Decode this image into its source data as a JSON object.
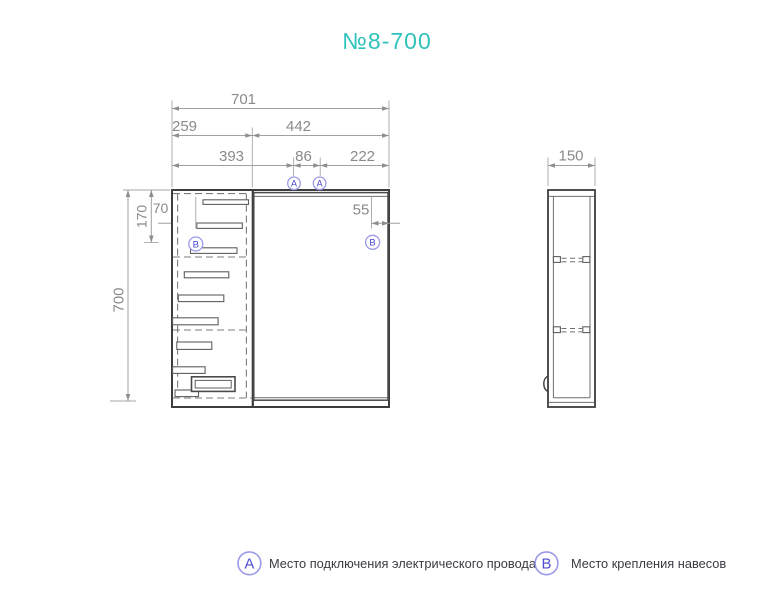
{
  "title": "№8-700",
  "colors": {
    "accent_teal": "#2fc2bb",
    "marker_blue": "#4646cc",
    "marker_ring": "#9a9ae8",
    "drawing_dark": "#3d3d3d",
    "dimension_gray": "#8a8a8a",
    "legend_text": "#3a3a42"
  },
  "front_view": {
    "dims": {
      "total_width": "701",
      "seg_row2": [
        "259",
        "442"
      ],
      "seg_row3": [
        "393",
        "86",
        "222"
      ],
      "height": "700",
      "hinge_offset_top": "170",
      "hinge_offset_left": "70",
      "hinge_offset_right": "55"
    },
    "markers": {
      "electrical": "A",
      "hanger": "B"
    }
  },
  "side_view": {
    "dims": {
      "depth": "150"
    }
  },
  "legend": {
    "items": [
      {
        "marker": "A",
        "label": "Место подключения электрического провода"
      },
      {
        "marker": "B",
        "label": "Место крепления навесов"
      }
    ]
  }
}
